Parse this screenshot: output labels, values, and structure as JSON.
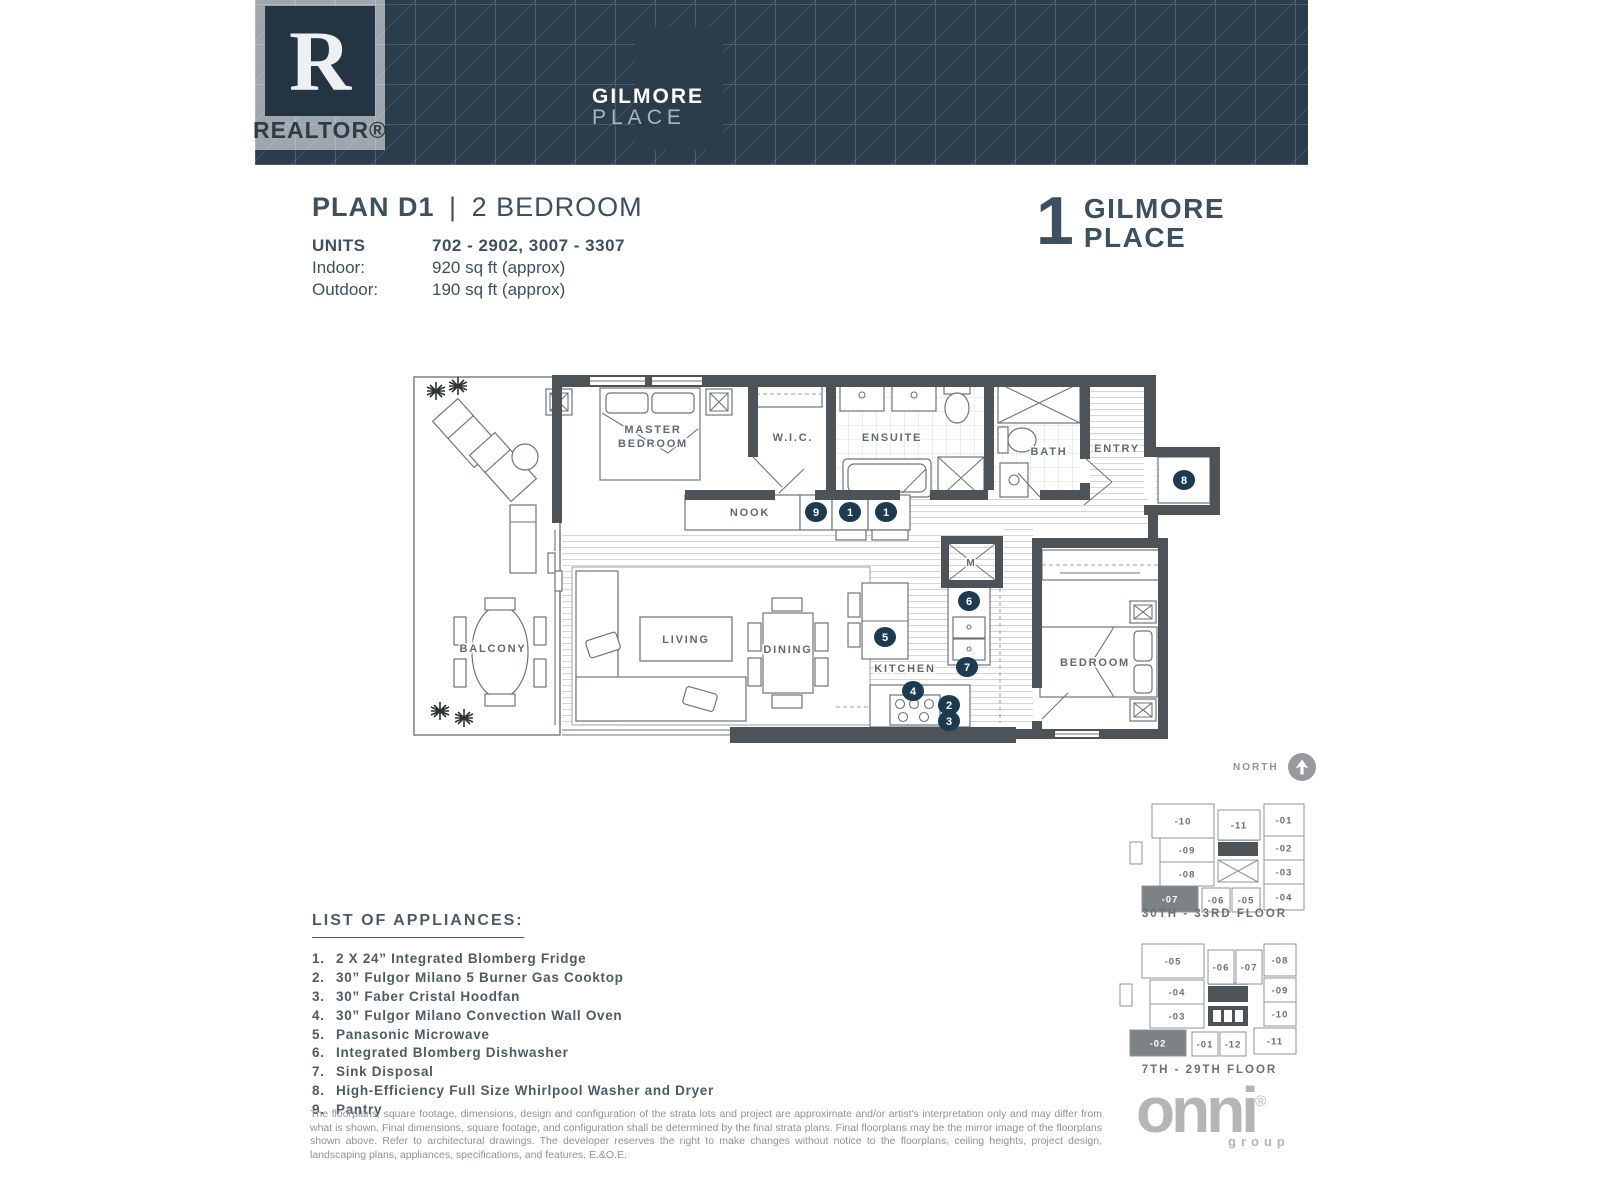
{
  "header": {
    "realtor": {
      "letter": "R",
      "word": "REALTOR®"
    },
    "brand": {
      "line1": "GILMORE",
      "line2": "PLACE"
    }
  },
  "plan": {
    "title_bold": "PLAN D1",
    "title_sep": "|",
    "title_rest": "2 BEDROOM",
    "specs": [
      {
        "label": "UNITS",
        "value": "702 - 2902, 3007 - 3307",
        "bold": true
      },
      {
        "label": "Indoor:",
        "value": "920 sq ft (approx)",
        "bold": false
      },
      {
        "label": "Outdoor:",
        "value": "190 sq ft (approx)",
        "bold": false
      }
    ]
  },
  "project_logo": {
    "number": "1",
    "line1": "GILMORE",
    "line2": "PLACE"
  },
  "floorplan": {
    "colors": {
      "wall": "#4d5357",
      "marker": "#1c3a50",
      "line": "#6d7478",
      "label": "#5f6a70"
    },
    "labels": [
      {
        "text": "MASTER",
        "x": 253,
        "y": 78
      },
      {
        "text": "BEDROOM",
        "x": 253,
        "y": 92
      },
      {
        "text": "W.I.C.",
        "x": 393,
        "y": 86
      },
      {
        "text": "ENSUITE",
        "x": 492,
        "y": 86
      },
      {
        "text": "BATH",
        "x": 649,
        "y": 100
      },
      {
        "text": "ENTRY",
        "x": 717,
        "y": 97
      },
      {
        "text": "NOOK",
        "x": 350,
        "y": 161
      },
      {
        "text": "LIVING",
        "x": 286,
        "y": 288
      },
      {
        "text": "DINING",
        "x": 388,
        "y": 298
      },
      {
        "text": "KITCHEN",
        "x": 505,
        "y": 317
      },
      {
        "text": "BEDROOM",
        "x": 695,
        "y": 311
      },
      {
        "text": "BALCONY",
        "x": 93,
        "y": 297
      },
      {
        "text": "M",
        "x": 571,
        "y": 211,
        "small": true
      }
    ],
    "markers": [
      {
        "n": "9",
        "x": 416,
        "y": 157
      },
      {
        "n": "1",
        "x": 450,
        "y": 157
      },
      {
        "n": "1",
        "x": 486,
        "y": 157
      },
      {
        "n": "8",
        "x": 784,
        "y": 125
      },
      {
        "n": "6",
        "x": 569,
        "y": 246
      },
      {
        "n": "5",
        "x": 485,
        "y": 282
      },
      {
        "n": "7",
        "x": 567,
        "y": 312
      },
      {
        "n": "4",
        "x": 513,
        "y": 336
      },
      {
        "n": "2",
        "x": 549,
        "y": 350
      },
      {
        "n": "3",
        "x": 549,
        "y": 366
      }
    ]
  },
  "north": {
    "label": "NORTH"
  },
  "keyplans": [
    {
      "title": "30TH - 33RD FLOOR",
      "units": [
        {
          "label": "-10",
          "x": 30,
          "y": 6,
          "w": 62,
          "h": 34,
          "hl": false
        },
        {
          "label": "-11",
          "x": 96,
          "y": 12,
          "w": 42,
          "h": 30,
          "hl": false
        },
        {
          "label": "-01",
          "x": 142,
          "y": 6,
          "w": 40,
          "h": 32,
          "hl": false
        },
        {
          "label": "-09",
          "x": 38,
          "y": 40,
          "w": 54,
          "h": 24,
          "hl": false
        },
        {
          "label": "-02",
          "x": 142,
          "y": 38,
          "w": 40,
          "h": 24,
          "hl": false
        },
        {
          "label": "-08",
          "x": 38,
          "y": 64,
          "w": 54,
          "h": 24,
          "hl": false
        },
        {
          "label": "-03",
          "x": 142,
          "y": 62,
          "w": 40,
          "h": 24,
          "hl": false
        },
        {
          "label": "-07",
          "x": 20,
          "y": 88,
          "w": 56,
          "h": 26,
          "hl": true
        },
        {
          "label": "-06",
          "x": 80,
          "y": 90,
          "w": 28,
          "h": 24,
          "hl": false
        },
        {
          "label": "-05",
          "x": 110,
          "y": 90,
          "w": 28,
          "h": 24,
          "hl": false
        },
        {
          "label": "-04",
          "x": 142,
          "y": 86,
          "w": 40,
          "h": 26,
          "hl": false
        }
      ]
    },
    {
      "title": "7TH - 29TH FLOOR",
      "units": [
        {
          "label": "-05",
          "x": 30,
          "y": 6,
          "w": 62,
          "h": 34,
          "hl": false
        },
        {
          "label": "-06",
          "x": 96,
          "y": 12,
          "w": 26,
          "h": 34,
          "hl": false
        },
        {
          "label": "-07",
          "x": 124,
          "y": 12,
          "w": 26,
          "h": 34,
          "hl": false
        },
        {
          "label": "-08",
          "x": 152,
          "y": 6,
          "w": 32,
          "h": 32,
          "hl": false
        },
        {
          "label": "-04",
          "x": 38,
          "y": 42,
          "w": 54,
          "h": 24,
          "hl": false
        },
        {
          "label": "-09",
          "x": 152,
          "y": 40,
          "w": 32,
          "h": 24,
          "hl": false
        },
        {
          "label": "-03",
          "x": 38,
          "y": 66,
          "w": 54,
          "h": 24,
          "hl": false
        },
        {
          "label": "-10",
          "x": 152,
          "y": 64,
          "w": 32,
          "h": 24,
          "hl": false
        },
        {
          "label": "-02",
          "x": 18,
          "y": 92,
          "w": 56,
          "h": 26,
          "hl": true
        },
        {
          "label": "-01",
          "x": 80,
          "y": 94,
          "w": 26,
          "h": 24,
          "hl": false
        },
        {
          "label": "-12",
          "x": 108,
          "y": 94,
          "w": 26,
          "h": 24,
          "hl": false
        },
        {
          "label": "-11",
          "x": 142,
          "y": 90,
          "w": 42,
          "h": 26,
          "hl": false
        }
      ]
    }
  ],
  "appliances": {
    "title": "LIST OF APPLIANCES:",
    "items": [
      {
        "n": "1.",
        "text": "2 X 24” Integrated Blomberg Fridge"
      },
      {
        "n": "2.",
        "text": "30” Fulgor Milano 5 Burner Gas Cooktop"
      },
      {
        "n": "3.",
        "text": "30” Faber Cristal Hoodfan"
      },
      {
        "n": "4.",
        "text": "30” Fulgor Milano Convection Wall Oven"
      },
      {
        "n": "5.",
        "text": "Panasonic Microwave"
      },
      {
        "n": "6.",
        "text": "Integrated Blomberg Dishwasher"
      },
      {
        "n": "7.",
        "text": "Sink Disposal"
      },
      {
        "n": "8.",
        "text": "High-Efficiency Full Size Whirlpool Washer and Dryer"
      },
      {
        "n": "9.",
        "text": "Pantry"
      }
    ]
  },
  "disclaimer": "The floorplans, square footage, dimensions, design and configuration of the strata lots and project are approximate and/or artist's interpretation only and may differ from what is shown. Final dimensions, square footage, and configuration shall be determined by the final strata plans. Final floorplans may be the mirror image of the floorplans shown above. Refer to architectural drawings. The developer reserves the right to make changes without notice to the floorplans, ceiling heights, project design, landscaping plans, appliances, specifications, and features. E.&O.E.",
  "footer_logo": {
    "word": "onni",
    "reg": "®",
    "sub": "group"
  }
}
